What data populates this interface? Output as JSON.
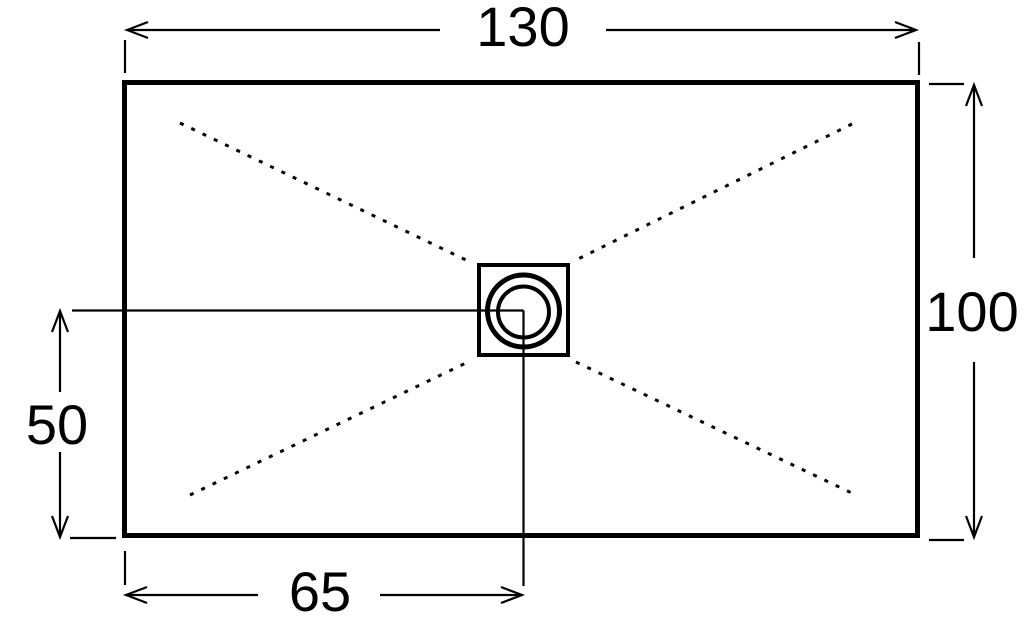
{
  "drawing": {
    "labels": {
      "overall_width": "130",
      "overall_depth": "100",
      "drain_offset_from_bottom": "50",
      "drain_offset_from_left": "65"
    },
    "colors": {
      "line": "#000000",
      "background": "#ffffff"
    }
  }
}
